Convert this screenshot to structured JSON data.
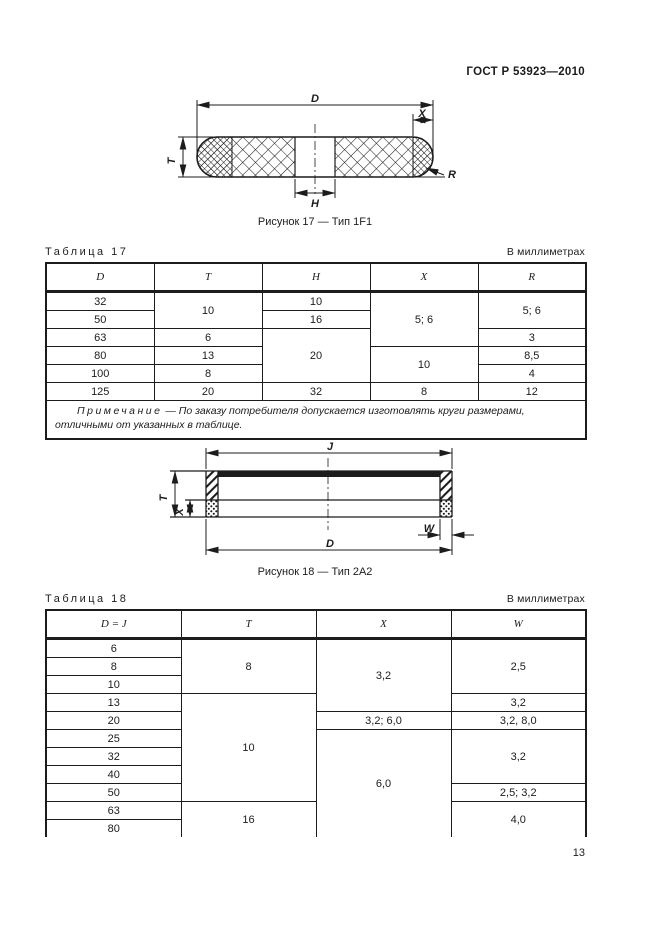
{
  "header": {
    "doc_number": "ГОСТ Р 53923—2010"
  },
  "figure17": {
    "caption": "Рисунок 17 — Тип 1F1",
    "dims": {
      "D": "D",
      "X": "X",
      "T": "T",
      "H": "H",
      "R": "R"
    }
  },
  "table17": {
    "label": "Таблица 17",
    "units": "В миллиметрах",
    "headers": [
      "D",
      "T",
      "H",
      "X",
      "R"
    ],
    "cells": {
      "d1": "32",
      "d2": "50",
      "d3": "63",
      "d4": "80",
      "d5": "100",
      "d6": "125",
      "t12": "10",
      "t3": "6",
      "t4": "13",
      "t5": "8",
      "t6": "20",
      "h1": "10",
      "h2": "16",
      "h345": "20",
      "h6": "32",
      "x123": "5; 6",
      "x45": "10",
      "x6": "8",
      "r12": "5; 6",
      "r3": "3",
      "r4": "8,5",
      "r5": "4",
      "r6": "12"
    },
    "note_label": "Примечание",
    "note_text": " — По заказу потребителя допускается изготовлять круги размерами, отличными от указанных в таблице."
  },
  "figure18": {
    "caption": "Рисунок 18 — Тип 2А2",
    "dims": {
      "J": "J",
      "T": "T",
      "X": "X",
      "W": "W",
      "D": "D"
    }
  },
  "table18": {
    "label": "Таблица 18",
    "units": "В миллиметрах",
    "headers": [
      "D = J",
      "T",
      "X",
      "W"
    ],
    "cells": {
      "d1": "6",
      "d2": "8",
      "d3": "10",
      "d4": "13",
      "d5": "20",
      "d6": "25",
      "d7": "32",
      "d8": "40",
      "d9": "50",
      "d10": "63",
      "d11": "80",
      "t123": "8",
      "t456789": "10",
      "t1011": "16",
      "x1234": "3,2",
      "x5": "3,2; 6,0",
      "x6_11": "6,0",
      "w123": "2,5",
      "w4": "3,2",
      "w5": "3,2, 8,0",
      "w678": "3,2",
      "w9": "2,5; 3,2",
      "w1011": "4,0"
    }
  },
  "page_number": "13",
  "colors": {
    "ink": "#1c1c1c",
    "paper": "#ffffff"
  }
}
